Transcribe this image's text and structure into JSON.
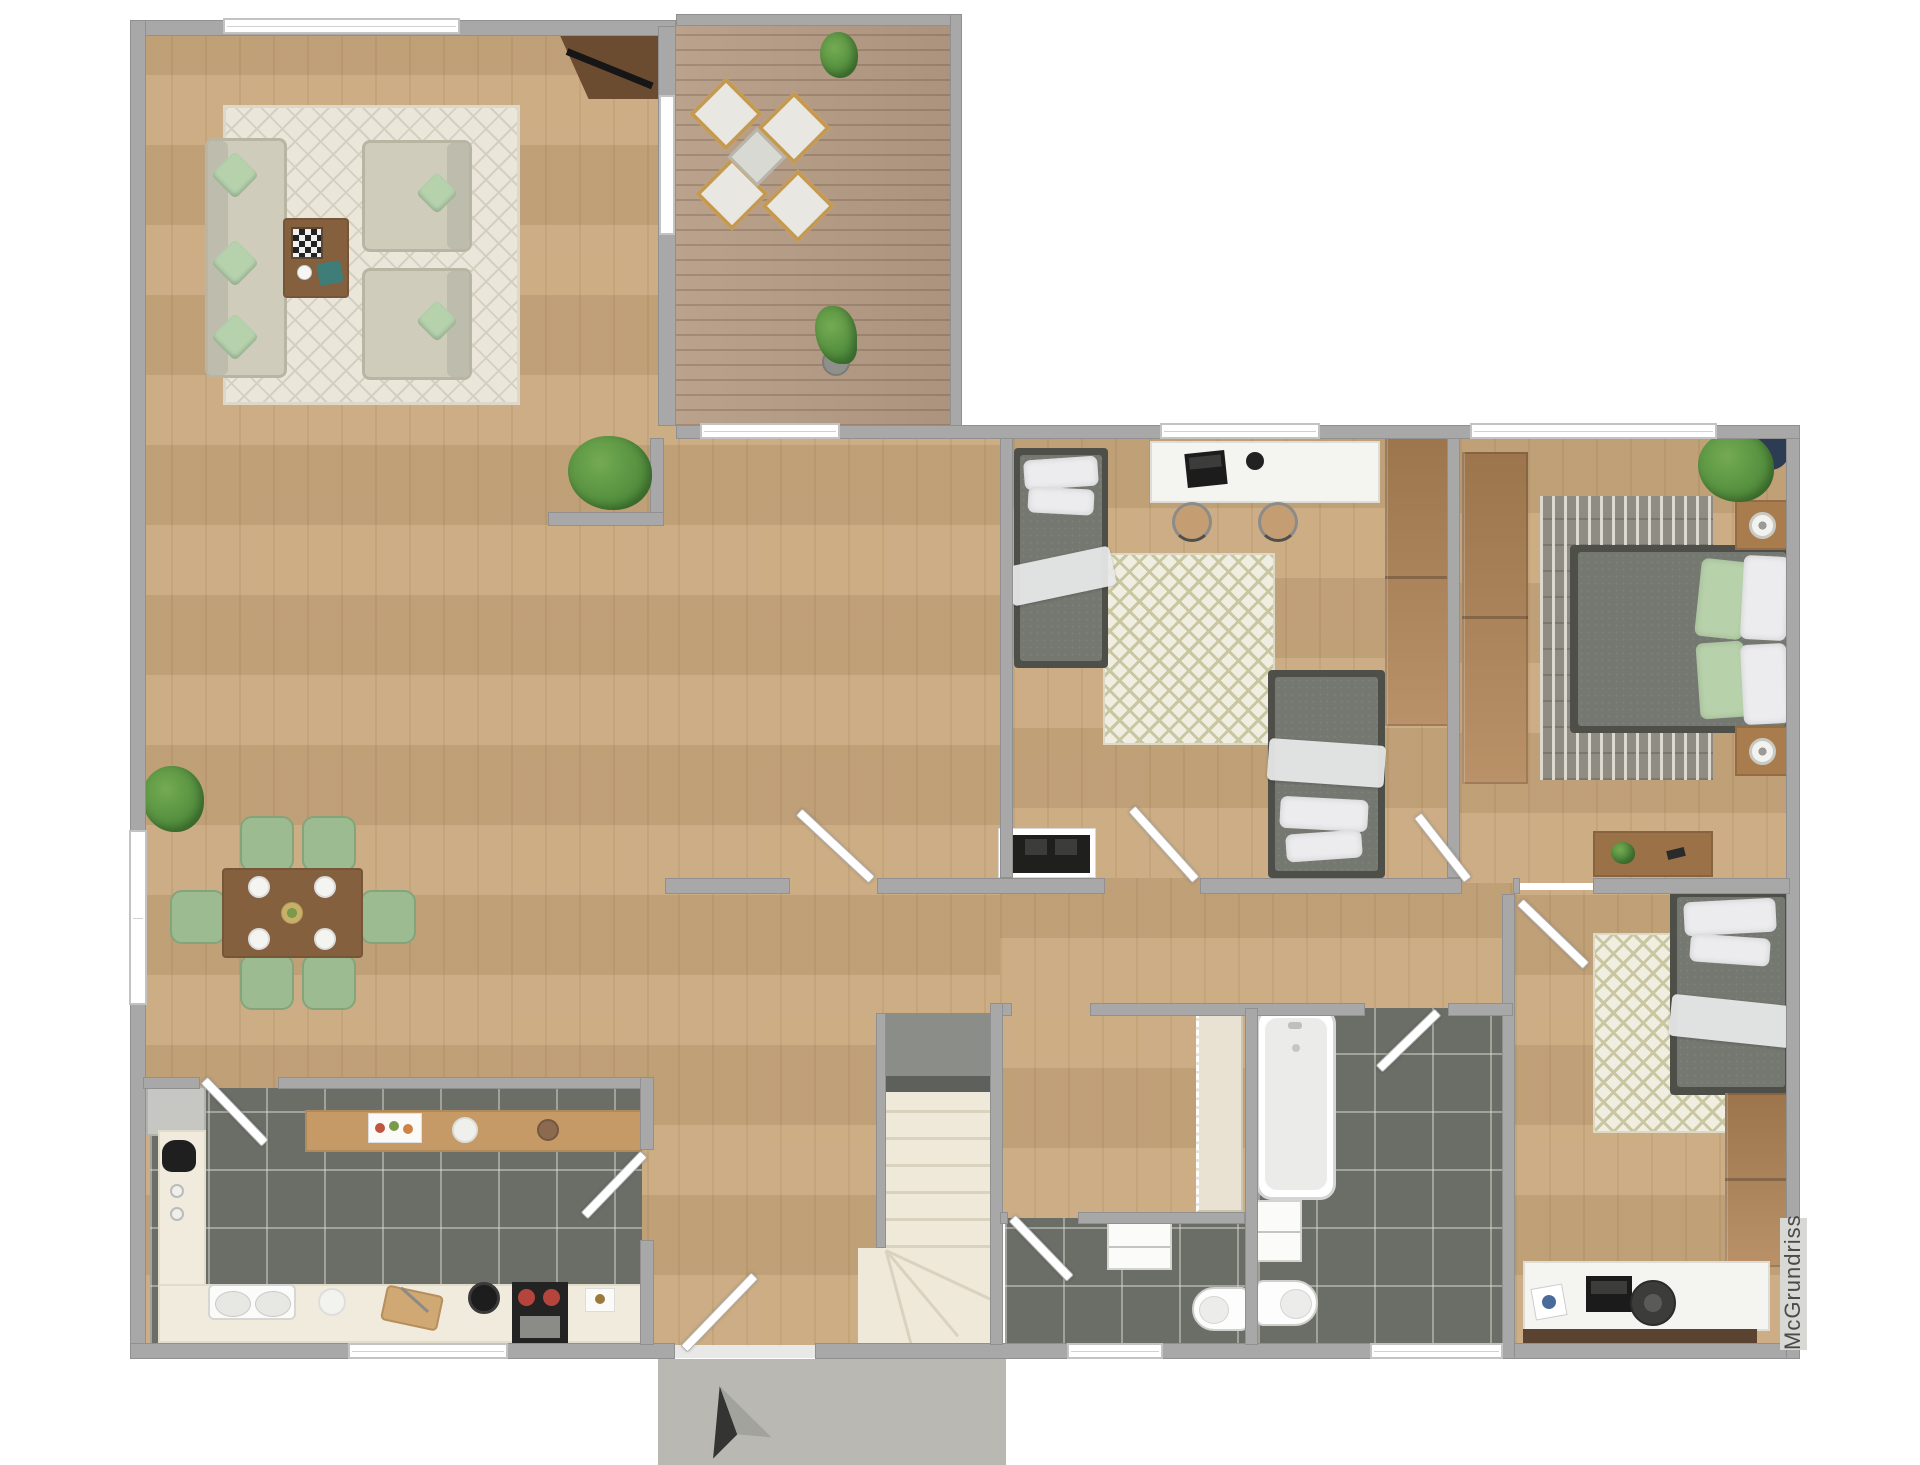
{
  "watermark": {
    "text": "McGrundriss"
  },
  "palette": {
    "wall": "#a8a8a8",
    "wallDark": "#909090",
    "wood": "#c9a87d",
    "woodDark": "#b28557",
    "deck": "#b69c85",
    "tile": "#6a6e66",
    "porch": "#b9b8b2",
    "counter": "#f0ebdd",
    "barWood": "#c59a66",
    "sofa": "#cfccbb",
    "sofaTrim": "#b8b5a3",
    "mint": "#b5d2ad",
    "rugLight": "#eae6da",
    "rugLine": "#d5cfc1",
    "rugOlive": "#c9c7a2",
    "rugOliveBg": "#f0ede1",
    "rugMaster": "#8f8c84",
    "rugMasterDash": "#ddd9cf",
    "tableWood": "#84603f",
    "chairSage": "#9cbb90",
    "bedFrame": "#4e4f48",
    "bedGray": "#747870",
    "pillow": "#ececee",
    "pillowGreen": "#b7d1ab",
    "plant": "#4d8a3a",
    "plantLight": "#74aa52",
    "stairCream": "#efe9da",
    "stairLand": "#8b8e88",
    "accentRed": "#b5453c",
    "potNavy": "#2c3c52",
    "sill": "#5a4330",
    "closet": "#e9e2d2",
    "applianceGray": "#c6c6c2",
    "dark": "#1e1e1e",
    "text": "#4a4a4a"
  },
  "rooms": [
    {
      "id": "living-room",
      "furniture": [
        "sofa",
        "armchair",
        "armchair",
        "coffee-table",
        "chessboard",
        "rug",
        "tv-sideboard"
      ]
    },
    {
      "id": "dining-area",
      "furniture": [
        "dining-table",
        "six-chairs",
        "plates",
        "plant"
      ]
    },
    {
      "id": "terrace",
      "furniture": [
        "outdoor-table",
        "four-chairs",
        "plant",
        "plant"
      ]
    },
    {
      "id": "kitchen",
      "furniture": [
        "fridge",
        "counter",
        "bar-counter",
        "double-sink",
        "cooktop",
        "coffee-maker",
        "cutting-board",
        "pot"
      ]
    },
    {
      "id": "hallway",
      "furniture": [
        "staircase",
        "entry-door"
      ]
    },
    {
      "id": "kids-bedroom",
      "furniture": [
        "bed",
        "bed",
        "desk",
        "desk-chair",
        "desk-chair",
        "wardrobe",
        "rug",
        "sideboard"
      ]
    },
    {
      "id": "master-bedroom",
      "furniture": [
        "double-bed",
        "nightstand",
        "nightstand",
        "wardrobe",
        "desk",
        "rug",
        "plant"
      ]
    },
    {
      "id": "bedroom-3",
      "furniture": [
        "bed",
        "desk",
        "desk-chair",
        "wardrobe",
        "rug"
      ]
    },
    {
      "id": "bathroom",
      "furniture": [
        "bathtub",
        "toilet",
        "cabinet"
      ]
    },
    {
      "id": "wc",
      "furniture": [
        "toilet",
        "wall-cabinet"
      ]
    },
    {
      "id": "storage",
      "furniture": [
        "built-in-closet"
      ]
    },
    {
      "id": "entry-porch",
      "furniture": [
        "north-arrow"
      ]
    }
  ]
}
